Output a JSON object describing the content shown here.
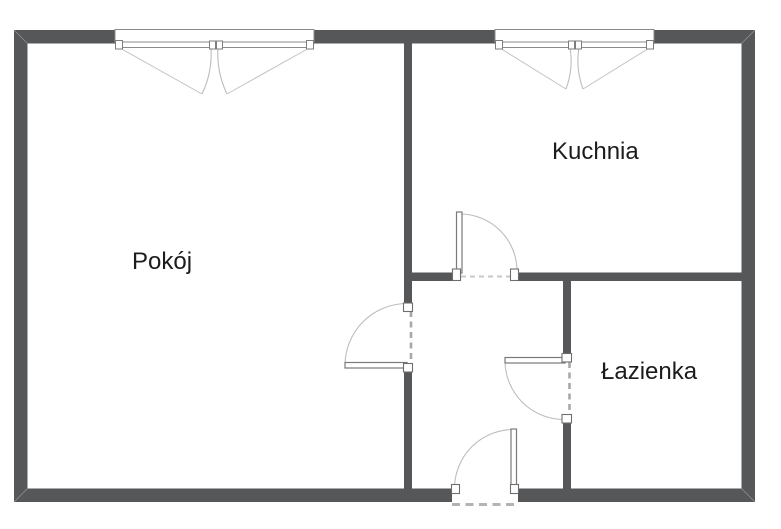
{
  "plan": {
    "type": "apartment-floor-plan",
    "rooms": {
      "room": {
        "label": "Pokój"
      },
      "kitchen": {
        "label": "Kuchnia"
      },
      "bathroom": {
        "label": "Łazienka"
      }
    },
    "elements": {
      "windows": [
        "room-window",
        "kitchen-window"
      ],
      "doors": [
        "room-door",
        "kitchen-door",
        "bathroom-door",
        "entrance-door"
      ]
    },
    "colors": {
      "wall": "#555759",
      "door_swing_line": "#bdbdbd",
      "dashed_opening_line": "#a8a8a8",
      "window_outline": "#8a8a8a",
      "label_text": "#1c1c1c",
      "background": "#ffffff"
    }
  }
}
